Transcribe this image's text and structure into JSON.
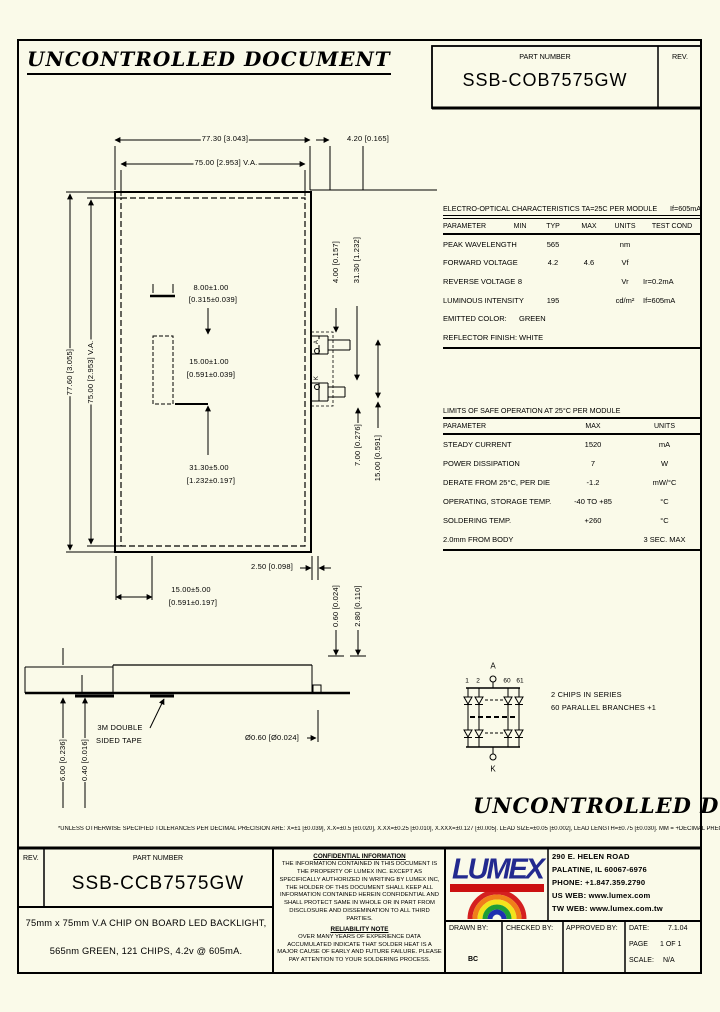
{
  "page": {
    "watermark": "UNCONTROLLED DOCUMENT",
    "tolerance_note": "*UNLESS OTHERWISE SPECIFIED TOLERANCES PER DECIMAL PRECISION ARE: X=±1 [±0.039], X.X=±0.5 [±0.020], X.XX=±0.25 [±0.010], X.XXX=±0.127 [±0.005].   LEAD SIZE=±0.05 [±0.002], LEAD LENGTH=±0.75 [±0.030].   MM = +DECIMAL PRECISION −0.00    MM = +0.00 −DECIMAL PRECISION"
  },
  "header": {
    "part_number_label": "PART NUMBER",
    "part_number": "SSB-COB7575GW",
    "rev_label": "REV."
  },
  "eo_table": {
    "title": "ELECTRO-OPTICAL CHARACTERISTICS TA=25C PER MODULE",
    "condition": "If=605mA",
    "headers": [
      "PARAMETER",
      "MIN",
      "TYP",
      "MAX",
      "UNITS",
      "TEST COND"
    ],
    "rows": [
      [
        "PEAK WAVELENGTH",
        "",
        "565",
        "",
        "nm",
        ""
      ],
      [
        "FORWARD VOLTAGE",
        "",
        "4.2",
        "4.6",
        "Vf",
        ""
      ],
      [
        "REVERSE VOLTAGE",
        "8",
        "",
        "",
        "Vr",
        "Ir=0.2mA"
      ],
      [
        "LUMINOUS INTENSITY",
        "",
        "195",
        "",
        "cd/m²",
        "If=605mA"
      ],
      [
        "EMITTED COLOR:",
        "GREEN"
      ],
      [
        "REFLECTOR FINISH:",
        "WHITE"
      ]
    ]
  },
  "limits_table": {
    "title": "LIMITS OF SAFE OPERATION AT 25°C PER MODULE",
    "headers": [
      "PARAMETER",
      "MAX",
      "UNITS"
    ],
    "rows": [
      [
        "STEADY CURRENT",
        "1520",
        "mA"
      ],
      [
        "POWER DISSIPATION",
        "7",
        "W"
      ],
      [
        "DERATE FROM 25°C, PER DIE",
        "-1.2",
        "mW/°C"
      ],
      [
        "OPERATING, STORAGE TEMP.",
        "-40 TO +85",
        "°C"
      ],
      [
        "SOLDERING TEMP.",
        "+260",
        "°C"
      ],
      [
        "2.0mm FROM BODY",
        "",
        "3 SEC. MAX"
      ]
    ]
  },
  "dims": {
    "top_width": "77.30 [3.043]",
    "top_va": "75.00 [2.953] V.A.",
    "top_offset": "4.20 [0.165]",
    "left_height": "77.60 [3.055]",
    "left_va": "75.00 [2.953] V.A.",
    "conn_w": "8.00±1.00",
    "conn_w_in": "[0.315±0.039]",
    "conn_h": "15.00±1.00",
    "conn_h_in": "[0.591±0.039]",
    "conn_y": "31.30±5.00",
    "conn_y_in": "[1.232±0.197]",
    "r1": "4.00 [0.157]",
    "r2": "31.30 [1.232]",
    "r3": "7.00 [0.276]",
    "r4": "15.00 [0.591]",
    "b1": "2.50 [0.098]",
    "b2": "15.00±5.00",
    "b2_in": "[0.591±0.197]",
    "b3": "0.60 [0.024]",
    "b4": "2.80 [0.110]",
    "tape": "3M DOUBLE",
    "tape2": "SIDED TAPE",
    "pin": "Ø0.60 [Ø0.024]",
    "s1": "6.00 [0.236]",
    "s2": "0.40 [0.016]",
    "term_a": "A",
    "term_k": "K"
  },
  "circuit": {
    "a": "A",
    "k": "K",
    "n1": "1",
    "n2": "2",
    "n60": "60",
    "n61": "61",
    "note1": "2 CHIPS IN SERIES",
    "note2": "60 PARALLEL BRANCHES +1"
  },
  "title_block": {
    "rev_label": "REV.",
    "part_number_label": "PART NUMBER",
    "part_number": "SSB-CCB7575GW",
    "description_line1": "75mm x 75mm V.A CHIP ON BOARD LED BACKLIGHT,",
    "description_line2": "565nm GREEN, 121 CHIPS, 4.2v @ 605mA.",
    "confidential_title": "CONFIDENTIAL INFORMATION",
    "confidential_body": "THE INFORMATION CONTAINED IN THIS DOCUMENT IS THE PROPERTY OF LUMEX INC.  EXCEPT AS SPECIFICALLY AUTHORIZED IN WRITING BY LUMEX INC, THE HOLDER OF THIS DOCUMENT SHALL KEEP ALL INFORMATION CONTAINED HEREIN CONFIDENTIAL AND SHALL PROTECT SAME IN WHOLE OR IN PART FROM DISCLOSURE AND DISSEMINATION TO ALL THIRD PARTIES.",
    "reliability_title": "RELIABILITY NOTE",
    "reliability_body": "OVER MANY YEARS OF EXPERIENCE DATA ACCUMULATED INDICATE THAT SOLDER HEAT IS A MAJOR CAUSE OF EARLY AND FUTURE FAILURE. PLEASE PAY ATTENTION TO YOUR SOLDERING PROCESS.",
    "logo_text": "LUMEX",
    "address_line1": "290 E. HELEN ROAD",
    "address_line2": "PALATINE, IL  60067-6976",
    "phone": "PHONE: +1.847.359.2790",
    "us_web": "US WEB: www.lumex.com",
    "tw_web": "TW WEB: www.lumex.com.tw",
    "drawn_by_label": "DRAWN BY:",
    "drawn_by": "BC",
    "checked_by_label": "CHECKED BY:",
    "approved_by_label": "APPROVED BY:",
    "date_label": "DATE:",
    "date": "7.1.04",
    "page_label": "PAGE",
    "page": "1 OF 1",
    "scale_label": "SCALE:",
    "scale": "N/A"
  }
}
